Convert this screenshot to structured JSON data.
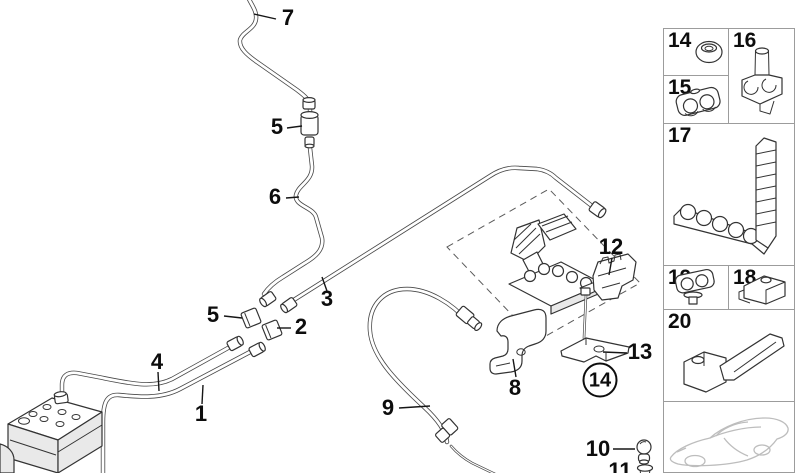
{
  "main": {
    "callouts": {
      "c7": "7",
      "c5a": "5",
      "c6": "6",
      "c3": "3",
      "c5b": "5",
      "c2": "2",
      "c4": "4",
      "c1": "1",
      "c9": "9",
      "c12": "12",
      "c13": "13",
      "c8": "8",
      "c14": "14",
      "c10": "10",
      "c11": "11"
    }
  },
  "sidebar": {
    "boxes": {
      "b14": "14",
      "b15": "15",
      "b16": "16",
      "b17": "17",
      "b19": "19",
      "b18": "18",
      "b20": "20"
    },
    "icons": {
      "b14": "grommet-nut-icon",
      "b15": "pipe-clamp-icon",
      "b16": "pipe-holder-clip-icon",
      "b17": "multi-clip-rail-icon",
      "b19": "clamp-with-rivet-icon",
      "b18": "clamp-block-icon",
      "b20": "holder-bracket-icon",
      "car": "vehicle-outline-icon"
    }
  },
  "colors": {
    "background": "#ffffff",
    "line_art": "#333333",
    "tube_outline": "#474747",
    "box_border": "#9c9c9c",
    "car_outline": "#bdbdbd",
    "label_text": "#0d0d0d"
  }
}
